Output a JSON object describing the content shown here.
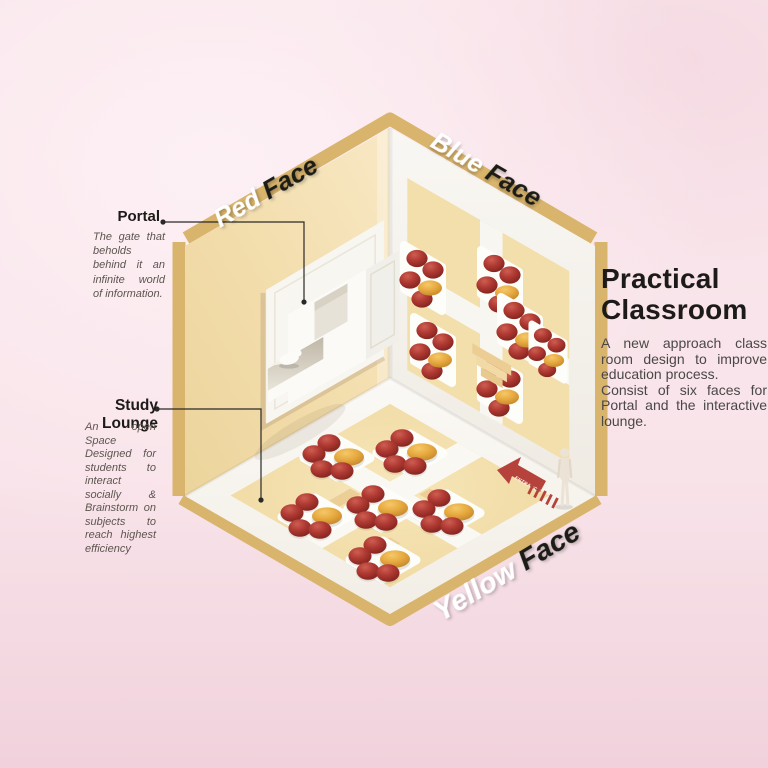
{
  "poster": {
    "title_line1": "Practical",
    "title_line2": "Classroom",
    "description_p1": "A new approach class room design to improve education process.",
    "description_p2": "Consist of six faces for Portal and the interactive lounge."
  },
  "annotations": {
    "portal": {
      "label": "Portal",
      "description": "The gate that beholds behind it an infinite world of information."
    },
    "study_lounge": {
      "label": "Study Lounge",
      "description": "An open Space Designed for students to interact socially & Brainstorm on subjects to reach highest efficiency"
    }
  },
  "face_labels": {
    "red": {
      "word1": "Red",
      "word2": "Face"
    },
    "blue": {
      "word1": "Blue",
      "word2": "Face"
    },
    "yellow": {
      "word1": "Yellow",
      "word2": "Face"
    }
  },
  "entrance_arrow": {
    "label": "ENTRANCE"
  },
  "scene": {
    "floor_table_groups": 6,
    "wall_table_groups": 5,
    "icons": {
      "entrance_arrow": "red arrow pointing into room with dashed trail",
      "person_figure": "standing human silhouette at entrance",
      "bird_sculpture": "white paper bird inside portal slot",
      "portal_cube": "white cubic frame protruding from red face wall"
    }
  },
  "colors": {
    "background_pink": "#f8e4ea",
    "ink": "#1d1b19",
    "text_gray": "#4a4846",
    "note_gray": "#5d5550",
    "wall_tan": "#f2dcaa",
    "trim_gold": "#d9b46c",
    "wall_white": "#f7f5f0",
    "floor_white": "#faf8f3",
    "panel_tan": "#f3dfab",
    "mat_white": "#fdfdfa",
    "chair_red": "#b03a33",
    "table_orange": "#e6a93f",
    "arrow_red": "#b5433c",
    "line_black": "#2b2927"
  }
}
